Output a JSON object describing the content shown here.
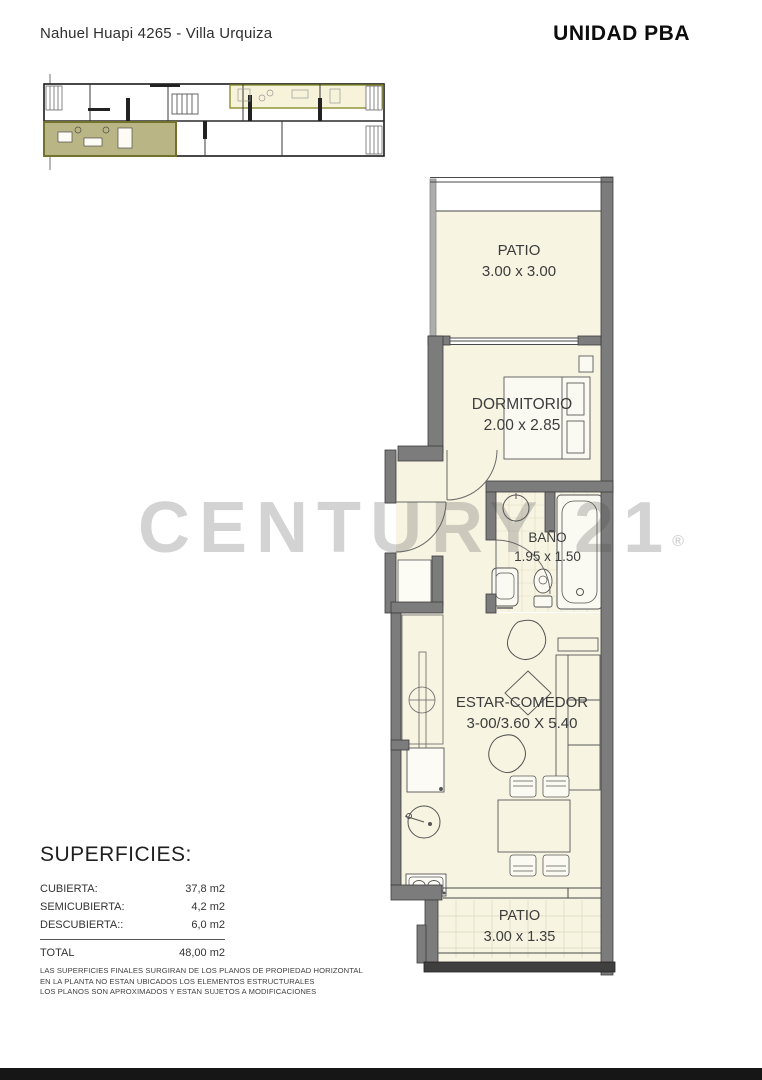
{
  "header": {
    "title": "Nahuel Huapi 4265 - Villa Urquiza",
    "unit": "UNIDAD PBA"
  },
  "watermark": {
    "text": "CENTURY 21",
    "registered": "®"
  },
  "rooms": [
    {
      "name": "PATIO",
      "dimensions": "3.00 x 3.00"
    },
    {
      "name": "DORMITORIO",
      "dimensions": "2.00 x 2.85"
    },
    {
      "name": "BAÑO",
      "dimensions": "1.95 x 1.50"
    },
    {
      "name": "ESTAR-COMEDOR",
      "dimensions": "3-00/3.60 X 5.40"
    },
    {
      "name": "PATIO",
      "dimensions": "3.00 x 1.35"
    }
  ],
  "superficies": {
    "title": "SUPERFICIES:",
    "rows": [
      {
        "label": "CUBIERTA:",
        "value": "37,8 m2"
      },
      {
        "label": "SEMICUBIERTA:",
        "value": "4,2 m2"
      },
      {
        "label": "DESCUBIERTA::",
        "value": "6,0 m2"
      }
    ],
    "total": {
      "label": "TOTAL",
      "value": "48,00 m2"
    }
  },
  "disclaimer": {
    "line1": "LAS SUPERFICIES FINALES SURGIRAN DE LOS PLANOS DE PROPIEDAD HORIZONTAL",
    "line2": "EN LA PLANTA NO ESTAN UBICADOS LOS ELEMENTOS ESTRUCTURALES",
    "line3": "LOS PLANOS SON APROXIMADOS Y ESTAN SUJETOS A MODIFICACIONES"
  },
  "colors": {
    "room_cream": "#f7f4e2",
    "wall_gray": "#7c7c7c",
    "highlight_olive": "#b9b584",
    "highlight_pale_strip": "#f6f3da",
    "watermark_gray": "#c9c9c9",
    "bottom_bar": "#161616"
  }
}
